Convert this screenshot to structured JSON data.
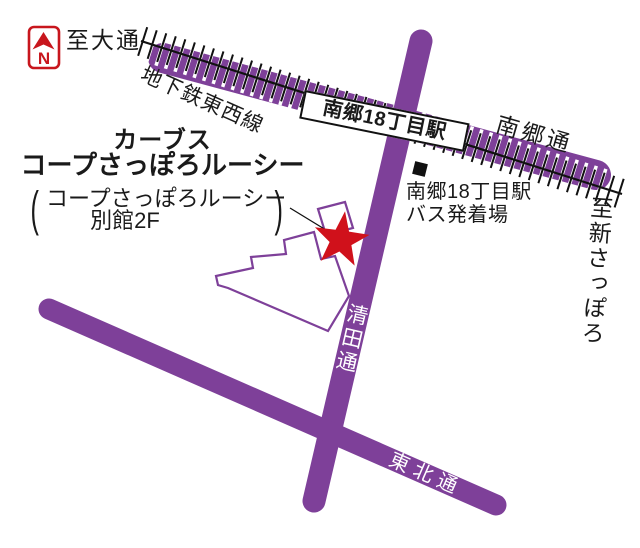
{
  "map": {
    "compass": {
      "letter": "N"
    },
    "to_odori": "至大通",
    "subway_line": "地下鉄東西線",
    "station": "南郷18丁目駅",
    "nango_dori": "南郷通",
    "to_shin_sapporo": "至新さっぽろ",
    "bus_stop": {
      "line1": "南郷18丁目駅",
      "line2": "バス発着場"
    },
    "kiyota_dori": "清田通",
    "tohoku_dori": "東北通",
    "destination": {
      "name_line1": "カーブス",
      "name_line2": "コープさっぽろルーシー",
      "paren_open": "(",
      "note_line1": "コープさっぽろルーシー",
      "note_line2": "別館2F",
      "paren_close": ")"
    },
    "colors": {
      "road_purple": "#7e4099",
      "marker_red": "#d0111b",
      "compass_red": "#c8161d",
      "text_black": "#1a1a1a",
      "rail_black": "#111111"
    }
  }
}
